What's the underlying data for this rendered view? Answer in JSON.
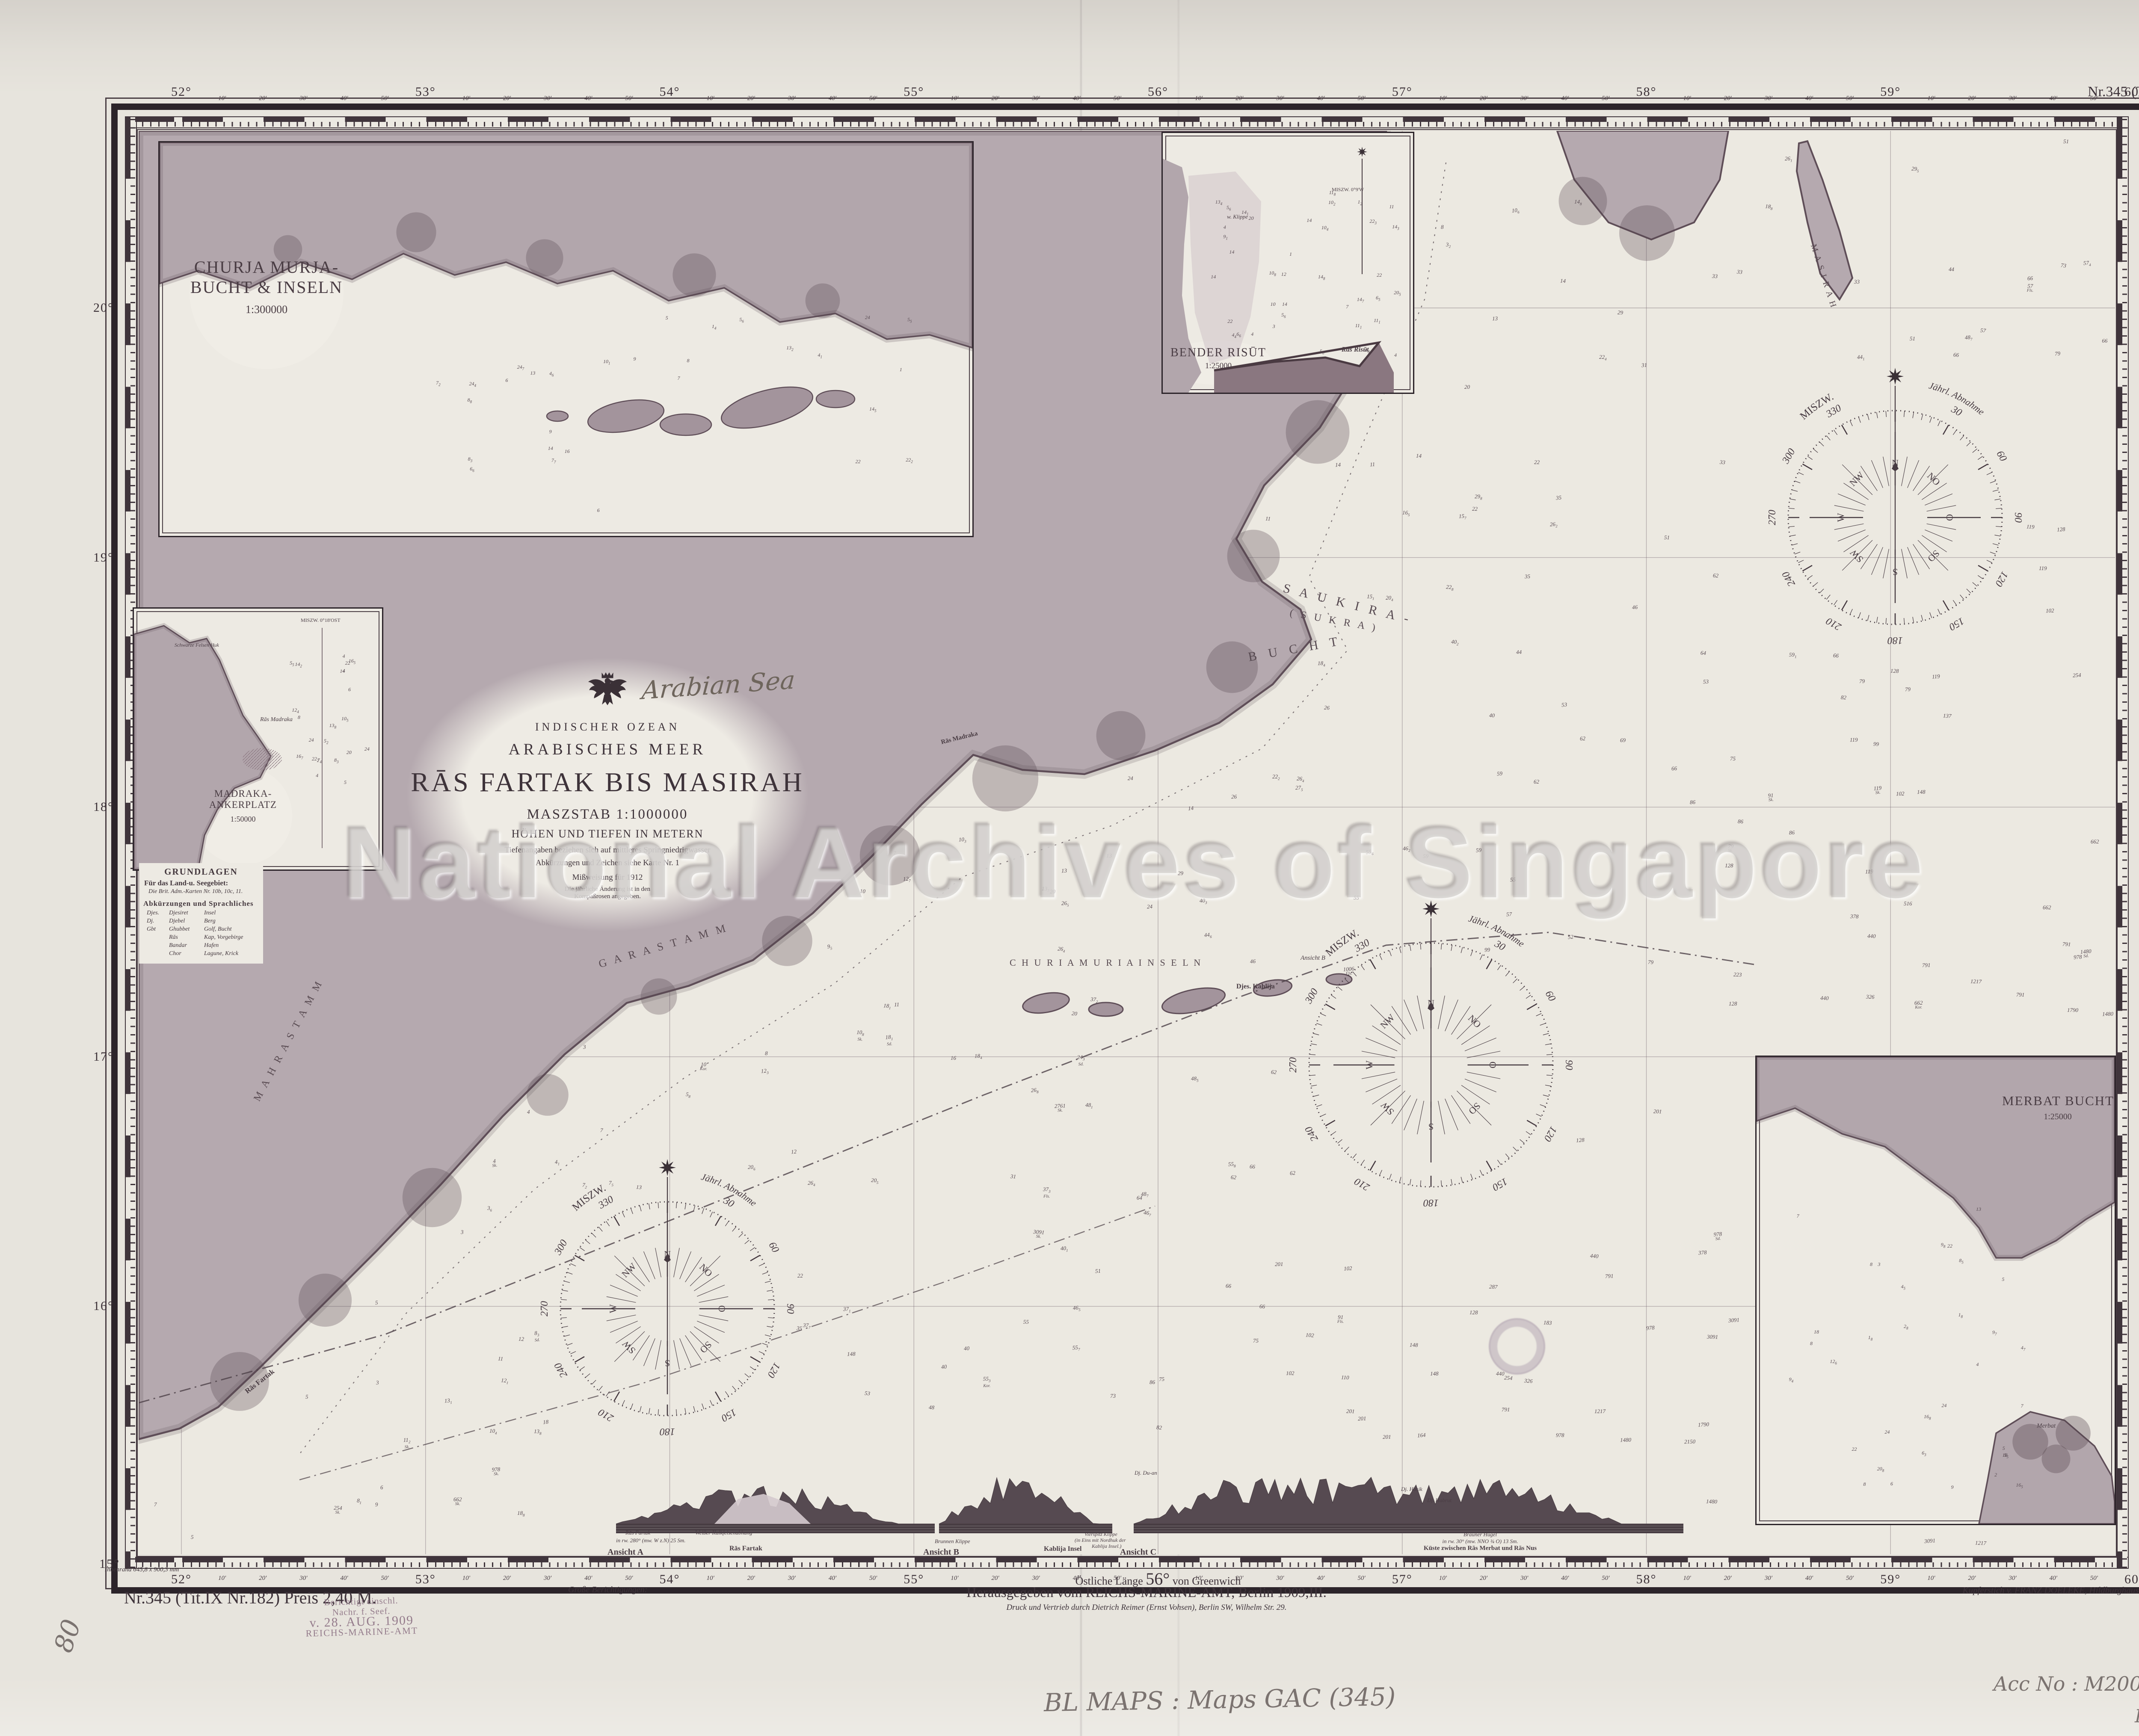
{
  "sheet": {
    "chart_no_top": "Nr.345 (Tit.IX Nr.182)",
    "chart_no_bottom": "Nr.345 (Tit.IX Nr.182) Preis 2,40 M.",
    "big_corrections": "Große Berichtigungen:",
    "innenrand": "Innenrand 645,8 x 900,3 mm",
    "imprint1": "Herausgegeben vom REICHS-MARINE-AMT, Berlin 1909,III.",
    "imprint2": "Druck und Vertrieb durch Dietrich Reimer (Ernst Vohsen), Berlin SW, Wilhelm Str. 29.",
    "engraver": "Kupferstich v. FRANZ DOELEKE, Hildburghausen.",
    "watermark": "National Archives of Singapore"
  },
  "stamp": {
    "l1": "Berichtigt einschl.",
    "l2": "Nachr. f. Seef.",
    "l3": "v. 28. AUG. 1909",
    "l4": "REICHS-MARINE-AMT"
  },
  "hand": {
    "sea": "Arabian Sea",
    "shelfmark": "BL MAPS : Maps GAC (345)",
    "acc": "Acc No : M2006 - 00315 - BL",
    "hc": "HC000 858",
    "corner": "80"
  },
  "title": {
    "region": "INDISCHER OZEAN",
    "sea": "ARABISCHES MEER",
    "main": "RĀS FARTAK BIS MASIRAH",
    "scale": "MASZSTAB 1:1000000",
    "units": "HÖHEN UND TIEFEN IN METERN",
    "note1": "Tiefenangaben beziehen sich auf mittleres Springniedrigwasser",
    "note2": "Abkürzungen und Zeichen siehe Karte Nr. 1",
    "note3": "Mißweisung für 1912",
    "note4": "Die jährliche Änderung ist in den",
    "note5": "Kompaßrosen angegeben."
  },
  "legend": {
    "heading": "GRUNDLAGEN",
    "l1": "Für das Land-u. Seegebiet:",
    "l2": "Die Brit. Adm.-Karten Nr. 10b, 10c, 11.",
    "abbrev": "Abkürzungen und Sprachliches",
    "rows": [
      [
        "Djes.",
        "Djesiret",
        "Insel"
      ],
      [
        "Dj.",
        "Djebel",
        "Berg"
      ],
      [
        "Gbt",
        "Ghubbet",
        "Golf, Bucht"
      ],
      [
        "",
        "Rās",
        "Kap, Vorgebirge"
      ],
      [
        "",
        "Bandar",
        "Hafen"
      ],
      [
        "",
        "Chor",
        "Lagune, Krick"
      ]
    ]
  },
  "grat": {
    "top": [
      "52°",
      "53°",
      "54°",
      "55°",
      "56°",
      "57°",
      "58°",
      "59°",
      "60°"
    ],
    "left": [
      "20°",
      "19°",
      "18°",
      "17°",
      "16°"
    ],
    "corner": "15°",
    "fifty": "50'",
    "minutes": [
      "10'",
      "20'",
      "30'",
      "40'",
      "50'"
    ],
    "bottom_pre": "Östliche Länge",
    "bottom_deg": "56°",
    "bottom_post": "von Greenwich"
  },
  "insets": {
    "churia": {
      "t1": "CHURJA MURJA-",
      "t2": "BUCHT & INSELN",
      "scale": "1:300000"
    },
    "madraka": {
      "t1": "MADRAKA-",
      "t2": "ANKERPLATZ",
      "scale": "1:50000",
      "lbl_huk": "Schwarze Felsen Huk",
      "lbl_ras": "Rās Madraka",
      "lbl_var": "MISZW. 0°18'OST"
    },
    "bender": {
      "t1": "BENDER RISŪT",
      "scale": "1:25000",
      "lbl_klippe": "w. Klippe",
      "lbl_ras": "Rās Risūt",
      "lbl_var": "MISZW. 0°9'W"
    },
    "merbat": {
      "t1": "MERBAT BUCHT",
      "scale": "1:25000",
      "lbl_town": "Merbat"
    }
  },
  "compass": {
    "variation": "MISZW.",
    "change": "Jährl. Abnahme",
    "degrees": [
      "30",
      "60",
      "90",
      "120",
      "150",
      "180",
      "210",
      "240",
      "270",
      "300",
      "330"
    ],
    "cardinals": [
      "N",
      "NO",
      "O",
      "SO",
      "S",
      "SW",
      "W",
      "NW"
    ]
  },
  "labels": {
    "saukira1": "S A U K I R A -",
    "saukira2": "( S U K R A )",
    "saukira3": "B U C H T",
    "churia_row": "C H U R I A   M U R I A   I N S E L N",
    "djes_kahlija": "Djes. Kahlija",
    "ansicht_b_note": "Ansicht B",
    "gara": "G A R A   S T A M M",
    "mahra": "M A H R A   S T A M M",
    "masirah": "M A S I R A H",
    "ras_fartak": "Rās Fartak",
    "ras_madraka": "Rās Madraka"
  },
  "profiles": {
    "a": {
      "ansicht": "Ansicht A",
      "l1": "Rās Fartak",
      "l2": "in rw. 280° (mw. W z.N) 25 Sm.",
      "mid": "Weißer Kalkfelsenabhang",
      "center": "Rās Fartak"
    },
    "b": {
      "ansicht": "Ansicht B",
      "left": "Brunnen Klippe",
      "center": "Kablija Insel",
      "r1": "Vierspitz Klippe",
      "r2": "(in Eins mit Nordhuk der",
      "r3": "Kablija Insel.)"
    },
    "c": {
      "ansicht": "Ansicht C",
      "lbl1": "Dj. Du-an",
      "lbl2": "Dj. Hasik",
      "lbl3": "Dj. Habrut",
      "cap1": "Brauner Hügel",
      "cap2": "in rw. 30° (mw. NNO ¾ O) 13 Sm.",
      "cap3": "Küste zwischen Rās Merbat und Rās Nus"
    }
  },
  "snd": {
    "values": [
      3,
      4,
      5,
      6,
      7,
      8,
      9,
      10,
      11,
      12,
      13,
      14,
      15,
      16,
      18,
      20,
      22,
      24,
      26,
      27,
      29,
      31,
      33,
      35,
      37,
      40,
      44,
      46,
      48,
      51,
      53,
      55,
      57,
      59,
      62,
      64,
      66,
      69,
      73,
      75,
      79,
      82,
      86,
      91,
      99,
      102,
      110,
      119,
      128,
      137,
      148,
      164,
      183,
      201,
      223,
      254,
      287,
      326,
      378,
      440,
      516,
      662,
      791,
      978,
      1006,
      1217,
      1480,
      1790,
      2150,
      2761,
      3091
    ],
    "inset_values": [
      1,
      2,
      3,
      4,
      5,
      6,
      7,
      8,
      9,
      10,
      11,
      12,
      13,
      14,
      16,
      18,
      20,
      22,
      24
    ],
    "suffixes": [
      "Sk.",
      "Sd.",
      "Fls.",
      "Kor."
    ],
    "deep": [
      {
        "v": "254",
        "s": "Sk."
      },
      {
        "v": "978",
        "s": "Sk."
      },
      {
        "v": "662",
        "s": "Sk."
      },
      {
        "v": "2761",
        "s": "Sk."
      },
      {
        "v": "3091",
        "s": "Sk."
      },
      {
        "v": "1006",
        "s": "Fls."
      },
      {
        "v": "99",
        "s": ""
      },
      {
        "v": "52",
        "s": ""
      },
      {
        "v": "148",
        "s": ""
      },
      {
        "v": "201",
        "s": ""
      }
    ]
  }
}
